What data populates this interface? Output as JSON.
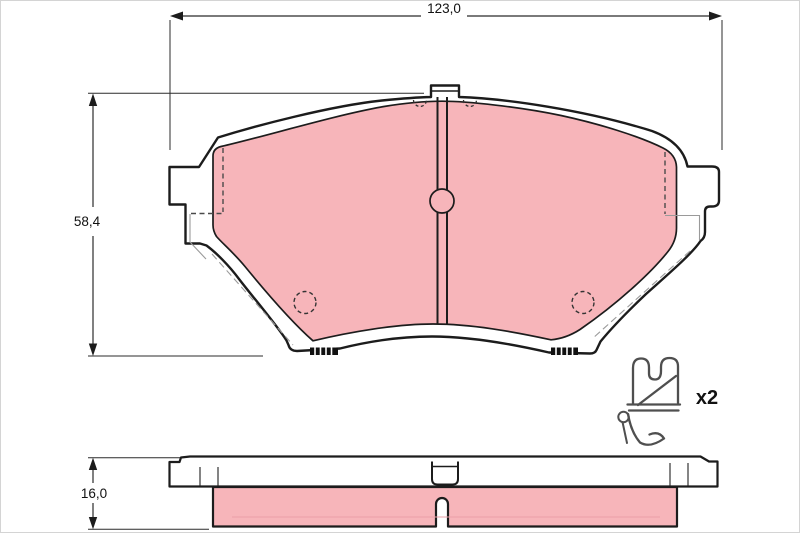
{
  "drawing": {
    "subject": "disc-brake-pad-set-technical-drawing",
    "views": {
      "front": "front-view",
      "side": "bottom-view",
      "accessory": "spring-clip"
    },
    "dimensions": {
      "width_label": "123,0",
      "height_label": "58,4",
      "thickness_label": "16,0"
    },
    "accessory": {
      "quantity_label": "x2"
    },
    "colors": {
      "friction_material": "#f7b5ba",
      "outline": "#1c1c1c",
      "dimension_line": "#2b2b2b",
      "hidden_line": "#4a4a4a",
      "light_hidden_line": "#9a9a9a",
      "clip_wire": "#4f4f4f",
      "background": "#ffffff",
      "frame_border": "#d4d4d4"
    }
  }
}
